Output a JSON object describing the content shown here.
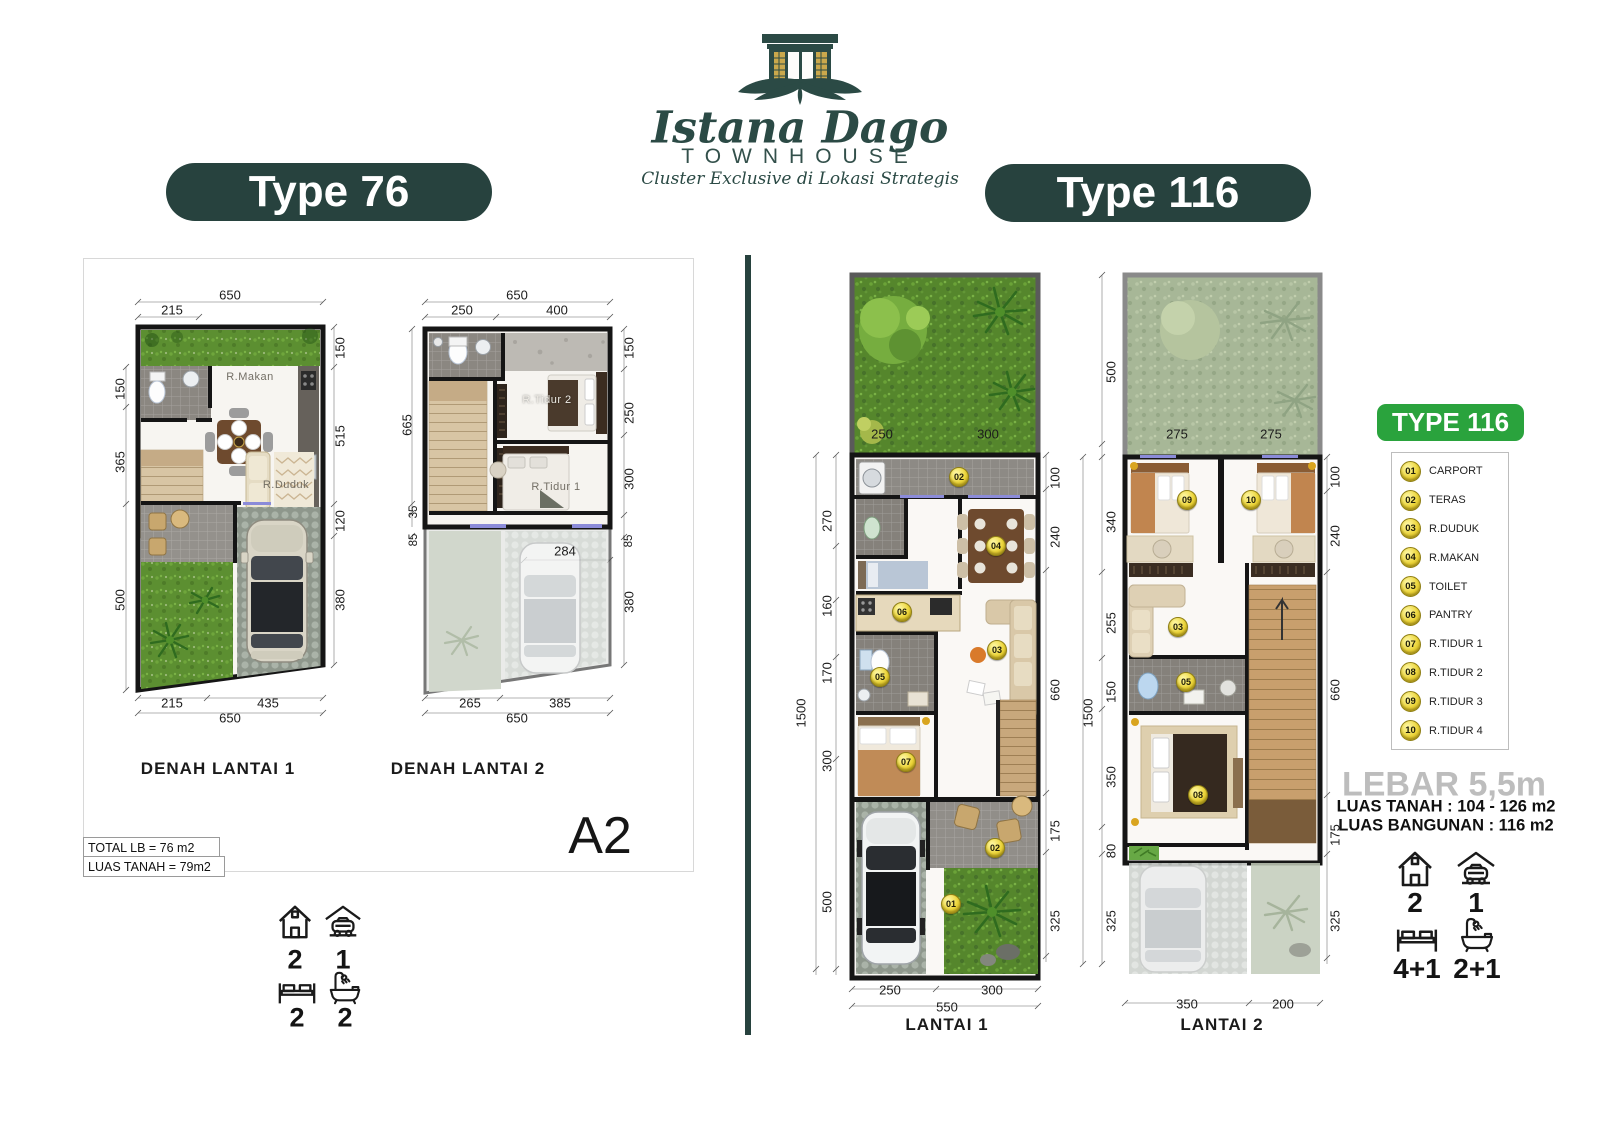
{
  "brand": {
    "name": "Istana Dago",
    "type": "TOWNHOUSE",
    "tagline": "Cluster Exclusive di Lokasi Strategis"
  },
  "type76": {
    "badge": "Type 76",
    "code": "A2",
    "total_lb": "TOTAL LB = 76 m2",
    "luas_tanah": "LUAS TANAH = 79m2",
    "plan1": {
      "caption": "DENAH LANTAI 1",
      "rooms": {
        "makan": "R.Makan",
        "duduk": "R.Duduk"
      },
      "dims": {
        "top": [
          "650",
          "215"
        ],
        "left": [
          "150",
          "365",
          "500"
        ],
        "right": [
          "150",
          "515",
          "120",
          "380"
        ],
        "bottom": [
          "215",
          "435",
          "650"
        ]
      }
    },
    "plan2": {
      "caption": "DENAH LANTAI 2",
      "rooms": {
        "tidur2": "R.Tidur 2",
        "tidur1": "R.Tidur 1"
      },
      "dims": {
        "top": [
          "650",
          "250",
          "400"
        ],
        "left": [
          "665",
          "35",
          "85"
        ],
        "right": [
          "150",
          "250",
          "300",
          "85",
          "380"
        ],
        "mid": [
          "284"
        ],
        "bottom": [
          "265",
          "385",
          "650"
        ]
      }
    },
    "stats": {
      "floors": "2",
      "carport": "1",
      "bedrooms": "2",
      "bathrooms": "2"
    }
  },
  "type116": {
    "badge": "Type 116",
    "lantai1": {
      "caption": "LANTAI 1",
      "garden_dims": [
        "250",
        "300"
      ],
      "dims": {
        "left": [
          "1500",
          "270",
          "160",
          "170",
          "300",
          "500"
        ],
        "right": [
          "100",
          "240",
          "660",
          "175",
          "325"
        ],
        "bottom": [
          "250",
          "300",
          "550"
        ]
      },
      "markers": [
        "02",
        "04",
        "06",
        "03",
        "05",
        "07",
        "02",
        "01"
      ]
    },
    "lantai2": {
      "caption": "LANTAI 2",
      "garden_dims": [
        "275",
        "275"
      ],
      "dims": {
        "left": [
          "500",
          "1500",
          "340",
          "255",
          "150",
          "350",
          "80",
          "325"
        ],
        "right": [
          "100",
          "240",
          "660",
          "175",
          "325"
        ],
        "bottom": [
          "350",
          "200"
        ]
      },
      "markers": [
        "09",
        "10",
        "03",
        "05",
        "08"
      ]
    },
    "legend": {
      "title": "TYPE 116",
      "items": [
        {
          "num": "01",
          "label": "CARPORT"
        },
        {
          "num": "02",
          "label": "TERAS"
        },
        {
          "num": "03",
          "label": "R.DUDUK"
        },
        {
          "num": "04",
          "label": "R.MAKAN"
        },
        {
          "num": "05",
          "label": "TOILET"
        },
        {
          "num": "06",
          "label": "PANTRY"
        },
        {
          "num": "07",
          "label": "R.TIDUR 1"
        },
        {
          "num": "08",
          "label": "R.TIDUR 2"
        },
        {
          "num": "09",
          "label": "R.TIDUR 3"
        },
        {
          "num": "10",
          "label": "R.TIDUR 4"
        }
      ]
    },
    "info": {
      "lebar": "LEBAR 5,5m",
      "luas_tanah": "LUAS TANAH : 104 - 126 m2",
      "luas_bangunan": "LUAS BANGUNAN : 116 m2"
    },
    "stats": {
      "floors": "2",
      "carport": "1",
      "bedrooms": "4+1",
      "bathrooms": "2+1"
    }
  },
  "colors": {
    "teal": "#27423e",
    "green": "#2aa33d",
    "marker_yellow": "#ecd53a"
  }
}
